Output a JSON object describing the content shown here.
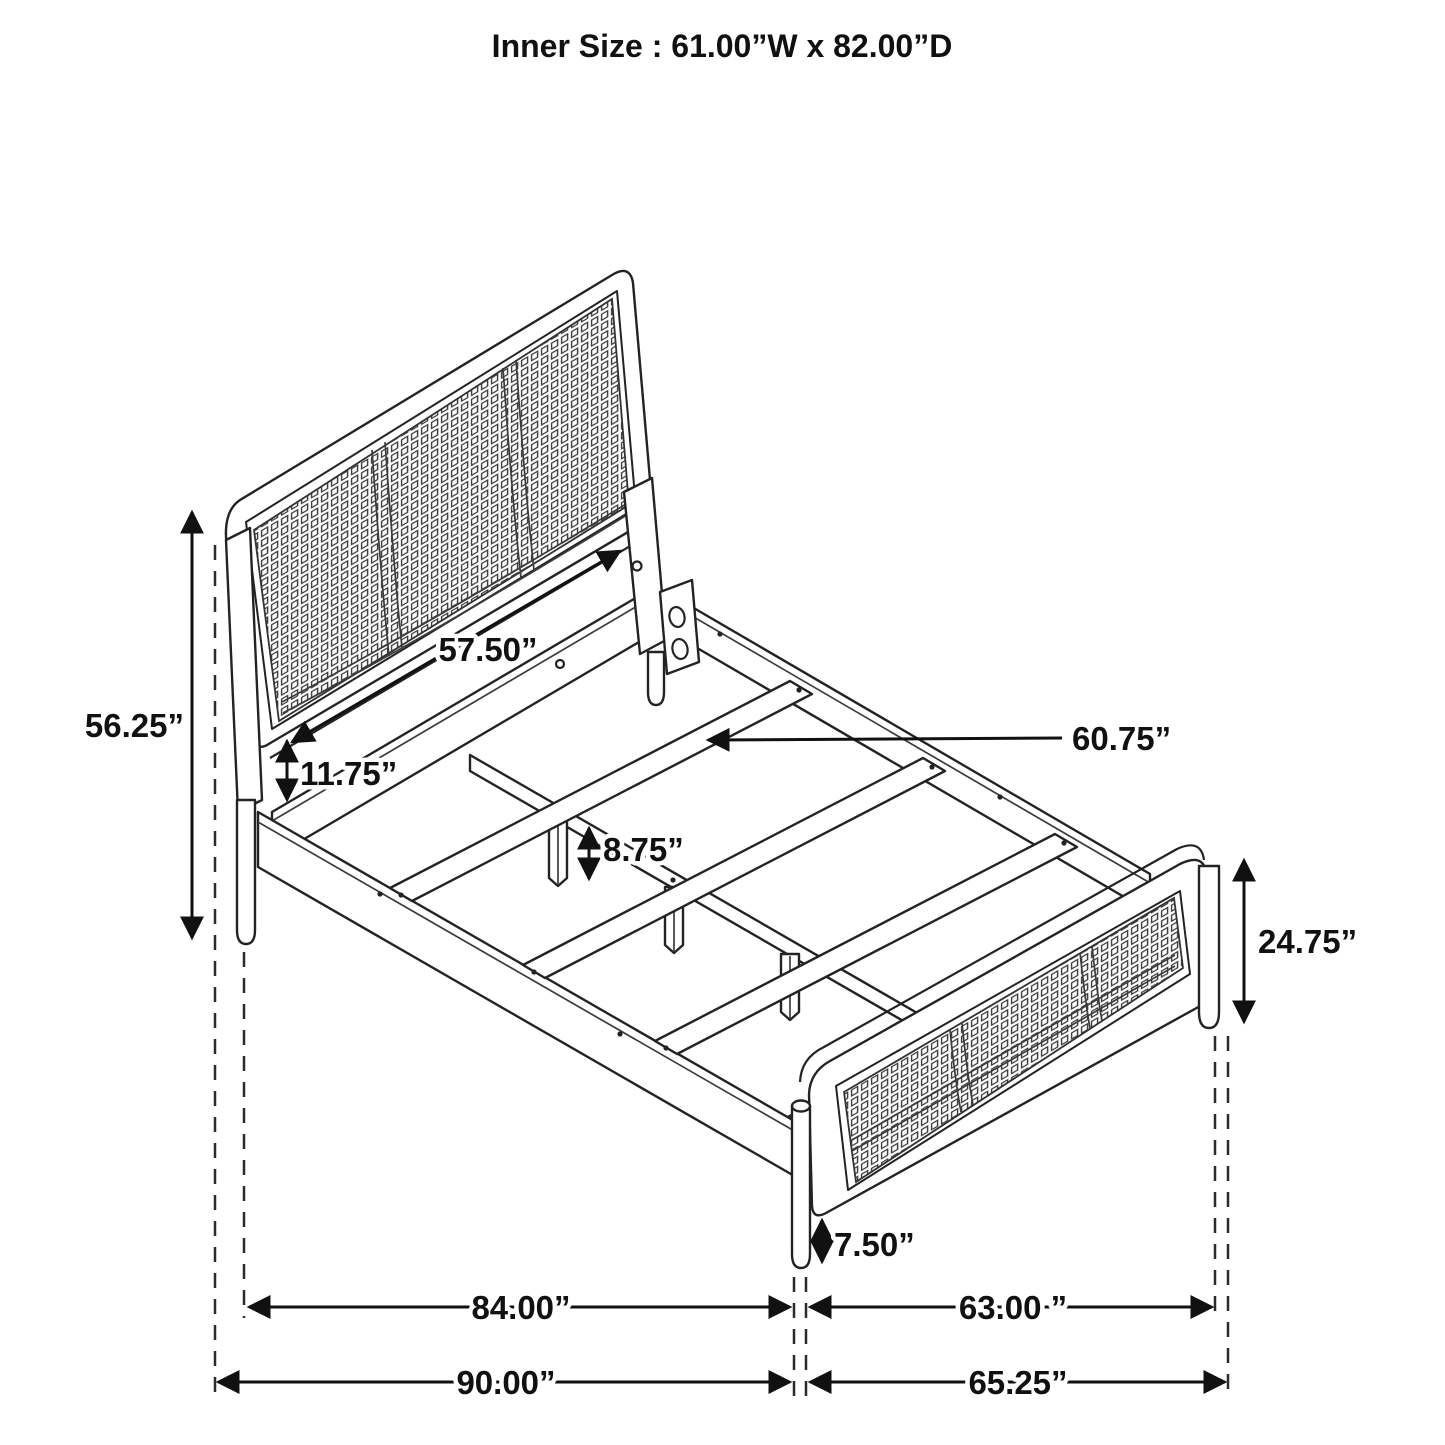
{
  "title": "Inner Size : 61.00”W x 82.00”D",
  "diagram": {
    "type": "furniture dimension diagram",
    "subject": "bed frame with cane headboard and footboard, isometric line drawing"
  },
  "annotations": {
    "headboard_height": "56.25”",
    "headboard_rail_length": "57.50”",
    "panel_to_rail_gap": "11.75”",
    "slat_support_leg_height": "8.75”",
    "slat_length": "60.75”",
    "footboard_height": "24.75”",
    "footboard_leg_height": "7.50”",
    "inner_length": "84.00”",
    "footboard_inner_width": "63.00 ”",
    "overall_length": "90.00”",
    "overall_width": "65.25”"
  }
}
